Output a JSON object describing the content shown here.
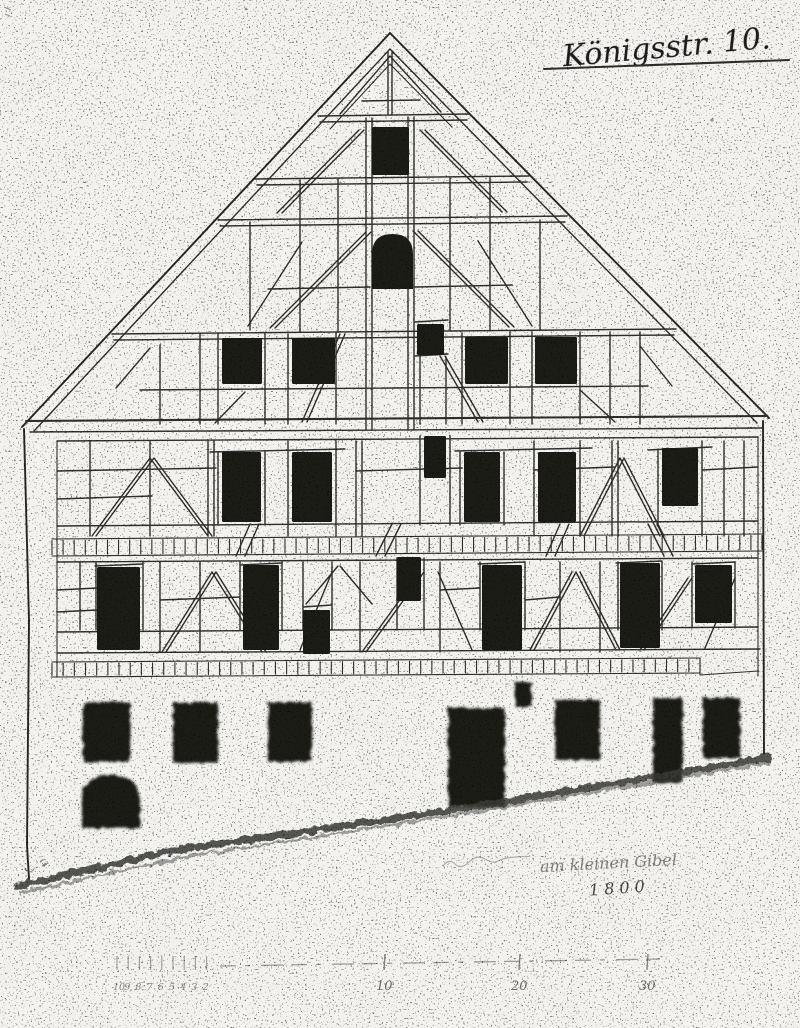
{
  "document": {
    "kind": "historical half-timbered house facade elevation (photocopied hand drawing)",
    "title": "Königsstr. 10.",
    "note": "am kleinen Gibel",
    "year": "1800"
  },
  "scale_bar": {
    "left_numbers": [
      "10",
      "9",
      "8",
      "7",
      "6",
      "5",
      "4",
      "3",
      "2"
    ],
    "left_start_x": 117,
    "left_step": 11.2,
    "major_numbers": [
      "10",
      "20",
      "30"
    ],
    "major_x": [
      385,
      520,
      648
    ],
    "labels_y": 990,
    "tick_top_y": 954,
    "tick_bottom_y": 970
  },
  "facade": {
    "colors": {
      "paper": "#f5f4f1",
      "ink": "#2e2d2b",
      "opening_fill": "#1b1a19"
    },
    "levels": [
      "gable-top",
      "gable-middle",
      "gable-window-row",
      "upper-story",
      "lower-story",
      "ground-floor"
    ],
    "brick_bands": [
      {
        "x1": 52,
        "y1": 539,
        "x2": 762,
        "y2": 534,
        "h": 17,
        "step": 11
      },
      {
        "x1": 52,
        "y1": 662,
        "x2": 700,
        "y2": 658,
        "h": 15,
        "step": 11
      }
    ],
    "openings": [
      {
        "name": "gable-top-window",
        "shape": "rect",
        "x": 372,
        "y": 127,
        "w": 37,
        "h": 48
      },
      {
        "name": "gable-arched-window",
        "shape": "arch",
        "x": 372,
        "y": 234,
        "w": 41,
        "h": 55
      },
      {
        "name": "gable-row-window-1",
        "shape": "rect",
        "x": 222,
        "y": 338,
        "w": 40,
        "h": 46
      },
      {
        "name": "gable-row-window-2",
        "shape": "rect",
        "x": 292,
        "y": 338,
        "w": 43,
        "h": 46
      },
      {
        "name": "gable-row-small-window",
        "shape": "rect",
        "x": 417,
        "y": 324,
        "w": 27,
        "h": 31
      },
      {
        "name": "gable-row-window-3",
        "shape": "rect",
        "x": 465,
        "y": 337,
        "w": 43,
        "h": 47
      },
      {
        "name": "gable-row-window-4",
        "shape": "rect",
        "x": 535,
        "y": 337,
        "w": 42,
        "h": 47
      },
      {
        "name": "upper-story-window-1",
        "shape": "rect",
        "x": 222,
        "y": 452,
        "w": 39,
        "h": 70
      },
      {
        "name": "upper-story-window-2",
        "shape": "rect",
        "x": 292,
        "y": 452,
        "w": 40,
        "h": 70
      },
      {
        "name": "upper-story-small-window",
        "shape": "rect",
        "x": 424,
        "y": 436,
        "w": 22,
        "h": 42
      },
      {
        "name": "upper-story-window-3",
        "shape": "rect",
        "x": 464,
        "y": 452,
        "w": 36,
        "h": 70
      },
      {
        "name": "upper-story-window-4",
        "shape": "rect",
        "x": 538,
        "y": 452,
        "w": 38,
        "h": 70
      },
      {
        "name": "upper-story-window-5",
        "shape": "rect",
        "x": 662,
        "y": 448,
        "w": 36,
        "h": 58
      },
      {
        "name": "lower-story-window-1",
        "shape": "rect",
        "x": 97,
        "y": 567,
        "w": 43,
        "h": 83
      },
      {
        "name": "lower-story-window-2",
        "shape": "rect",
        "x": 243,
        "y": 565,
        "w": 36,
        "h": 85
      },
      {
        "name": "lower-story-small-window",
        "shape": "rect",
        "x": 303,
        "y": 610,
        "w": 27,
        "h": 44
      },
      {
        "name": "lower-story-high-window",
        "shape": "rect",
        "x": 397,
        "y": 557,
        "w": 24,
        "h": 44
      },
      {
        "name": "lower-story-window-3",
        "shape": "rect",
        "x": 482,
        "y": 565,
        "w": 40,
        "h": 85
      },
      {
        "name": "lower-story-window-4",
        "shape": "rect",
        "x": 620,
        "y": 563,
        "w": 40,
        "h": 85
      },
      {
        "name": "lower-story-window-5",
        "shape": "rect",
        "x": 695,
        "y": 565,
        "w": 37,
        "h": 58
      },
      {
        "name": "ground-window-1",
        "shape": "rect",
        "x": 83,
        "y": 702,
        "w": 47,
        "h": 60,
        "soft": true
      },
      {
        "name": "ground-window-2",
        "shape": "rect",
        "x": 173,
        "y": 703,
        "w": 45,
        "h": 60,
        "soft": true
      },
      {
        "name": "ground-window-3",
        "shape": "rect",
        "x": 268,
        "y": 702,
        "w": 44,
        "h": 60,
        "soft": true
      },
      {
        "name": "cellar-arched-opening",
        "shape": "arch",
        "x": 82,
        "y": 775,
        "w": 58,
        "h": 53,
        "soft": true
      },
      {
        "name": "main-door",
        "shape": "rect",
        "x": 448,
        "y": 708,
        "w": 57,
        "h": 99,
        "soft": true
      },
      {
        "name": "ground-small-window",
        "shape": "rect",
        "x": 515,
        "y": 682,
        "w": 17,
        "h": 25,
        "soft": true
      },
      {
        "name": "ground-window-4",
        "shape": "rect",
        "x": 555,
        "y": 700,
        "w": 45,
        "h": 60,
        "soft": true
      },
      {
        "name": "side-door",
        "shape": "rect",
        "x": 653,
        "y": 698,
        "w": 30,
        "h": 85,
        "soft": true
      },
      {
        "name": "ground-window-5",
        "shape": "rect",
        "x": 703,
        "y": 698,
        "w": 37,
        "h": 60,
        "soft": true
      }
    ]
  }
}
